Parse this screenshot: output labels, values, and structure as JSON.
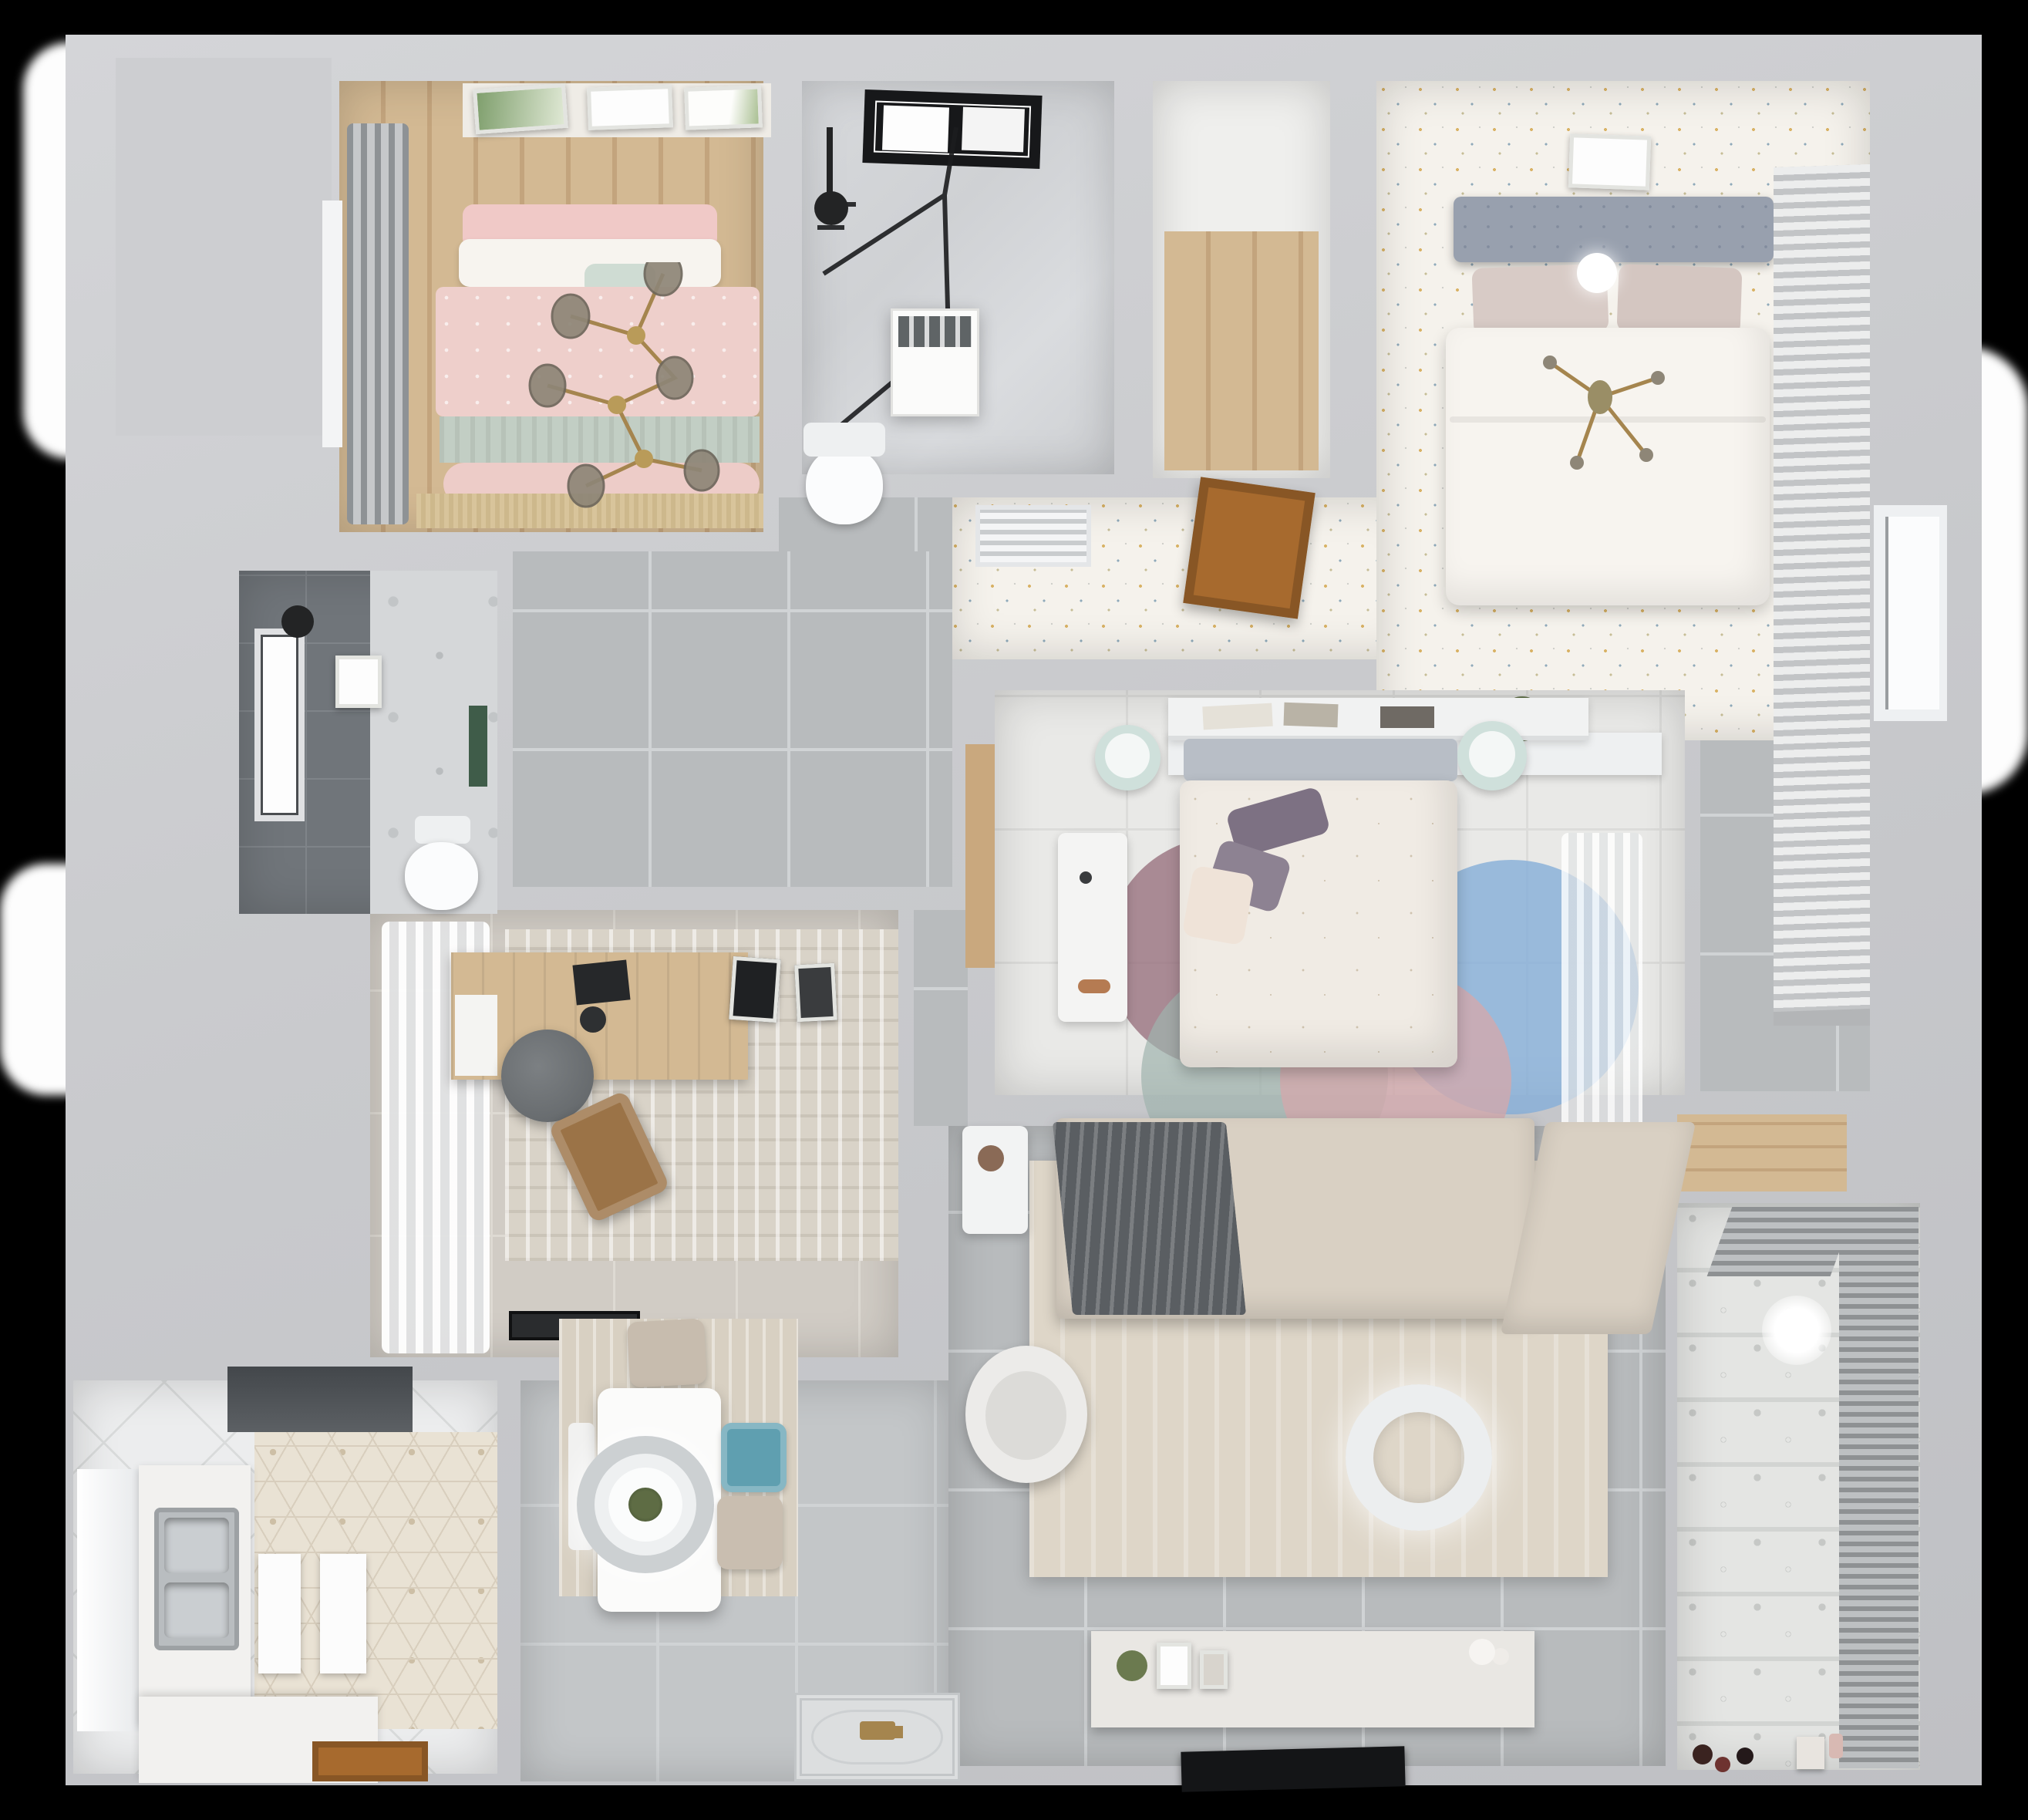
{
  "scene": {
    "kind": "3d-rendered-apartment-floor-plan",
    "view": "top-down-dollhouse-render",
    "background": "#000000"
  },
  "palette": {
    "bg": "#000000",
    "exterior": "#fdfdfd",
    "wall": "#c9cacd",
    "wallLight": "#d4d5d8",
    "tile": "#b8bbbd",
    "tileLine": "#d0d3d5",
    "speckle": "#f5f2ec",
    "wood": "#d3b993",
    "woodDark": "#c3a47d",
    "pinkBed": "#eecfcb",
    "sage": "#c2cec4",
    "cream": "#f7f4ef",
    "marble": "#d3d5d8",
    "darkTile": "#70757a",
    "hex": "#e9e2d4",
    "counter": "#f2f1ef",
    "steel": "#b9bdc0",
    "hood": "#54585c",
    "doorWood": "#a76a2e",
    "sofa": "#d9d0c3",
    "throwGray": "#5a5e62",
    "rugLiving": "#ded6c8",
    "rugDining": "#d8d0c2",
    "rugStudyFloor": "#d1ccc5",
    "teal": "#5f9fb0",
    "mint": "#cfe0db",
    "tv": "#141517",
    "balconyTile": "#e4e5e3",
    "blind": "#8e9193",
    "duvet": "#f0ebe4",
    "purple": "#7d7183",
    "rugBlue": "#85aed8",
    "rugMauve": "#97707c",
    "rugPink": "#d2a9ad",
    "headboardBlue": "#98a0ae",
    "gold": "#a5854e",
    "globe": "#8e8677",
    "plantGreen": "#51603e",
    "matDark": "#2a2c2e"
  },
  "rooms": {
    "bedroom1": {
      "name": "bedroom-pink",
      "furniture": [
        "double-bed-pink-duvet",
        "sage-throw",
        "pillows",
        "wall-art-frames",
        "branch-chandelier",
        "gray-curtain",
        "window",
        "tan-fringe-rug"
      ]
    },
    "bathroom1": {
      "name": "bathroom-top",
      "furniture": [
        "skylight-window",
        "glass-shower",
        "shower-head",
        "washing-machine",
        "toilet"
      ]
    },
    "closet": {
      "name": "walk-in-closet",
      "furniture": [
        "wood-floor"
      ]
    },
    "hallway": {
      "name": "hallway-speckled-floor",
      "furniture": [
        "louver-vent",
        "open-wood-door"
      ]
    },
    "bedroom2": {
      "name": "master-bedroom",
      "furniture": [
        "gray-tufted-headboard",
        "white-duvet-bed",
        "pillows",
        "art-frame",
        "sprig-chandelier",
        "white-sphere-lamp",
        "slatted-wardrobe",
        "low-console",
        "plant"
      ]
    },
    "bathroom3": {
      "name": "bathroom-dark",
      "furniture": [
        "dark-tile-wall",
        "window",
        "black-pendant",
        "toilet",
        "green-accent",
        "art-frame"
      ]
    },
    "study": {
      "name": "study",
      "furniture": [
        "white-curtain",
        "distressed-rug",
        "wood-desk",
        "laptop",
        "gray-round-chair",
        "brown-lounge-chair",
        "black-doormat",
        "desk-frames"
      ]
    },
    "kitchen": {
      "name": "kitchen",
      "furniture": [
        "range-hood",
        "hex-tile-wall",
        "double-steel-sink",
        "white-counters",
        "cabinet-panels",
        "wood-door",
        "window-light"
      ]
    },
    "dining": {
      "name": "dining-area",
      "furniture": [
        "white-table",
        "round-pendant-lamp",
        "teal-chair",
        "beige-chairs",
        "wood-look-rug",
        "ornate-entry-mat"
      ]
    },
    "bedroom3": {
      "name": "bedroom-center",
      "furniture": [
        "wall-shelf-books",
        "gray-headboard",
        "white-floral-duvet",
        "purple-pillows",
        "mint-poufs",
        "white-desk",
        "petal-rug-circles",
        "sheer-curtain",
        "door-threshold"
      ]
    },
    "living": {
      "name": "living-room",
      "furniture": [
        "l-shaped-sofa",
        "gray-throw",
        "beige-rug",
        "donut-pendant-lamp",
        "white-armchair",
        "side-table-plant",
        "tv-console",
        "flat-tv"
      ]
    },
    "balcony": {
      "name": "balcony",
      "furniture": [
        "patterned-cement-tiles",
        "venetian-blinds",
        "pendant-glow",
        "wood-shelf",
        "toys"
      ]
    },
    "entry": {
      "name": "entryway",
      "furniture": [
        "ornate-door-mat"
      ]
    }
  }
}
